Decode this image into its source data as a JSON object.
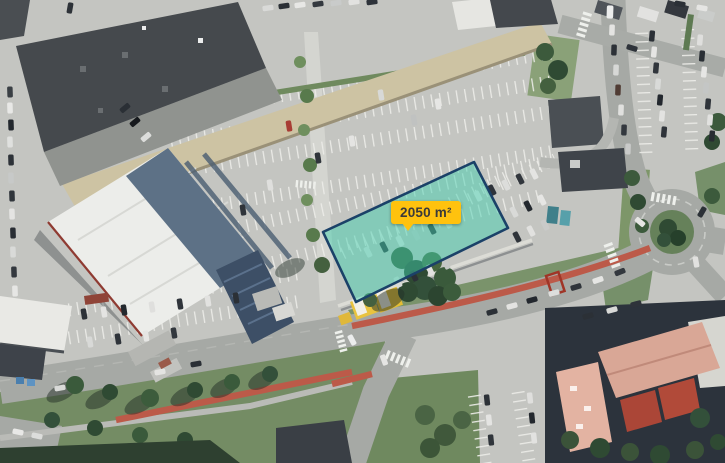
{
  "measurement": {
    "area_label": "2050 m²",
    "polygon_points": "474,162 508,228 356,302 323,232",
    "fill_color": "#3ecfae",
    "fill_opacity": "0.48",
    "stroke_color": "#1b4168",
    "label": {
      "background": "#ffc20e",
      "text_color": "#3a3a3a"
    }
  }
}
